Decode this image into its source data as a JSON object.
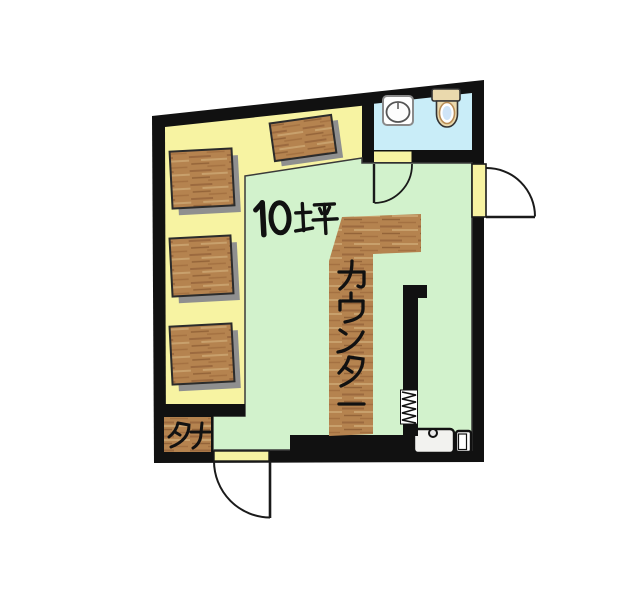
{
  "plan": {
    "area_label": "10坪",
    "counter_label": "カウンター",
    "shelf_label": "タナ",
    "colors": {
      "wall": "#111111",
      "raised_floor": "#f7f3a2",
      "main_floor": "#d2f2cc",
      "bathroom_floor": "#c9edf8",
      "wood": "#b5834f",
      "shadow": "#8f8f8f",
      "text": "#111111"
    },
    "fixtures": [
      {
        "name": "square-table",
        "count": 3
      },
      {
        "name": "tilted-table",
        "count": 1
      },
      {
        "name": "l-shaped-counter",
        "count": 1
      },
      {
        "name": "shelf",
        "count": 1
      },
      {
        "name": "bathroom-sink",
        "count": 1
      },
      {
        "name": "toilet",
        "count": 1
      },
      {
        "name": "kitchen-sink-unit",
        "count": 1
      },
      {
        "name": "door-swing",
        "count": 3
      },
      {
        "name": "accordion-screen",
        "count": 1
      }
    ]
  }
}
